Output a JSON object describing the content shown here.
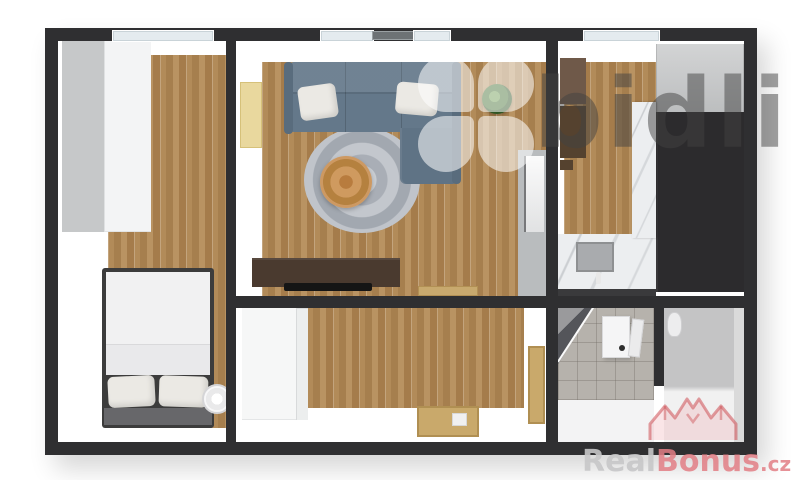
{
  "watermarks": {
    "bidli": {
      "text": "bidli"
    },
    "realbonus": {
      "brand_first": "Real",
      "brand_second": "Bonus",
      "domain_suffix": ".cz"
    }
  },
  "palette": {
    "wall": "#2f2f31",
    "wood_floor": "#ad8656",
    "sofa_blue_gray": "#64788a",
    "rug_gray": "#b6bac0",
    "pouf_orange": "#cd9356",
    "interior_door_yellow": "#e9d89e",
    "door_wood_tan": "#c9a96b",
    "marble": "#eceef0",
    "dark_cabinet": "#2c2b2d",
    "brown_cabinet": "#5d4a3b",
    "bathroom_tile": "#b6b2ac",
    "watermark_gray": "#424242",
    "watermark_red": "#cf4a52"
  },
  "floorplan": {
    "view": "3D top-down apartment floor plan render",
    "rooms": [
      {
        "name": "bedroom",
        "objects": [
          "window",
          "wardrobe",
          "double-bed",
          "pillows",
          "throw-blanket",
          "round-nightstand"
        ]
      },
      {
        "name": "living-room",
        "objects": [
          "windows",
          "corner-sofa",
          "sofa-pillows",
          "round-rug",
          "round-pouf",
          "potted-plant",
          "yellow-door",
          "tv-sideboard",
          "tv",
          "doormat",
          "doorway-to-kitchen"
        ]
      },
      {
        "name": "kitchen",
        "objects": [
          "window",
          "brown-upper-cabinets",
          "marble-column",
          "tall-dark-cabinets",
          "marble-counter",
          "sink",
          "faucet"
        ]
      },
      {
        "name": "hallway",
        "objects": [
          "built-in-wardrobe",
          "entrance-door-open",
          "door-to-bathroom"
        ]
      },
      {
        "name": "bathroom",
        "objects": [
          "corner-shower",
          "washbasin-vanity",
          "faucet"
        ]
      },
      {
        "name": "wc",
        "objects": [
          "toilet",
          "partition-wall"
        ]
      }
    ]
  }
}
